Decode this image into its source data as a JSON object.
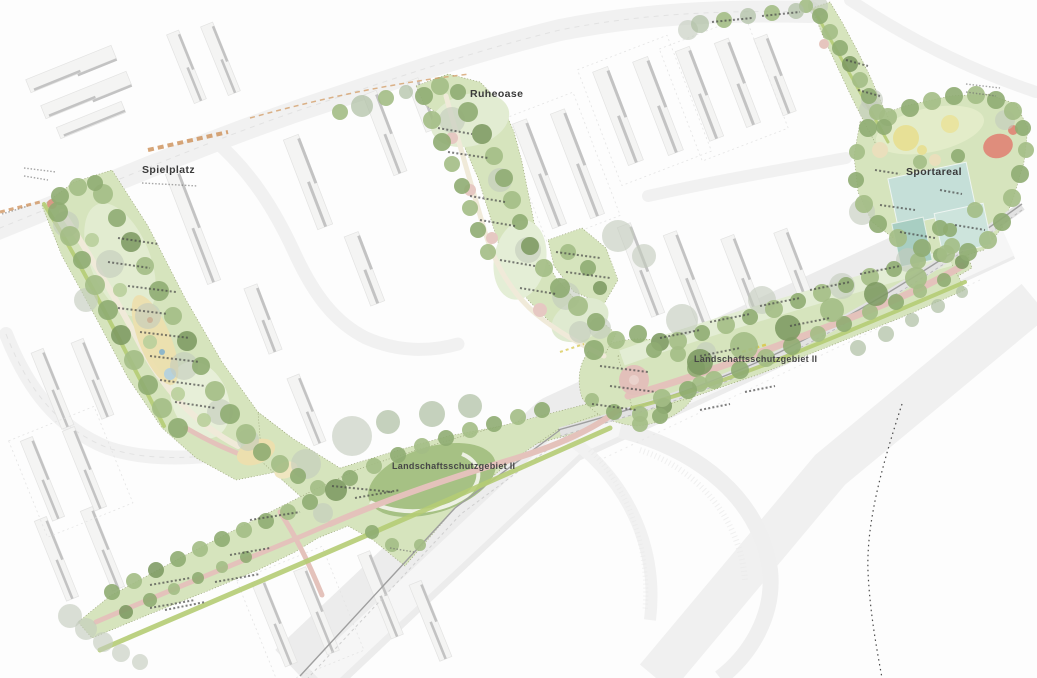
{
  "plan": {
    "labels": {
      "playground": "Spielplatz",
      "quiet_oasis": "Ruheoase",
      "sports_area": "Sportareal",
      "protected_landscape_east": "Landschaftsschutzgebiet II",
      "protected_landscape_south": "Landschaftsschutzgebiet II"
    },
    "palette": {
      "meadow_light": "#d6e4bd",
      "meadow_dark": "#a6c184",
      "tree_green_dark": "#7d9a62",
      "tree_green_mid": "#8fac72",
      "tree_green_light": "#b9cf9b",
      "tree_gray": "#c3ccbd",
      "path_pink": "#e4c2bb",
      "path_beige": "#f0ead9",
      "sport_court_teal": "#c5dfd8",
      "play_sand": "#ecdfae",
      "accent_yellow": "#e7e096",
      "accent_red": "#df8d7c",
      "building_gray": "#f4f4f3",
      "road_gray": "#e2e2e2",
      "marking_orange": "#cf9560"
    }
  }
}
